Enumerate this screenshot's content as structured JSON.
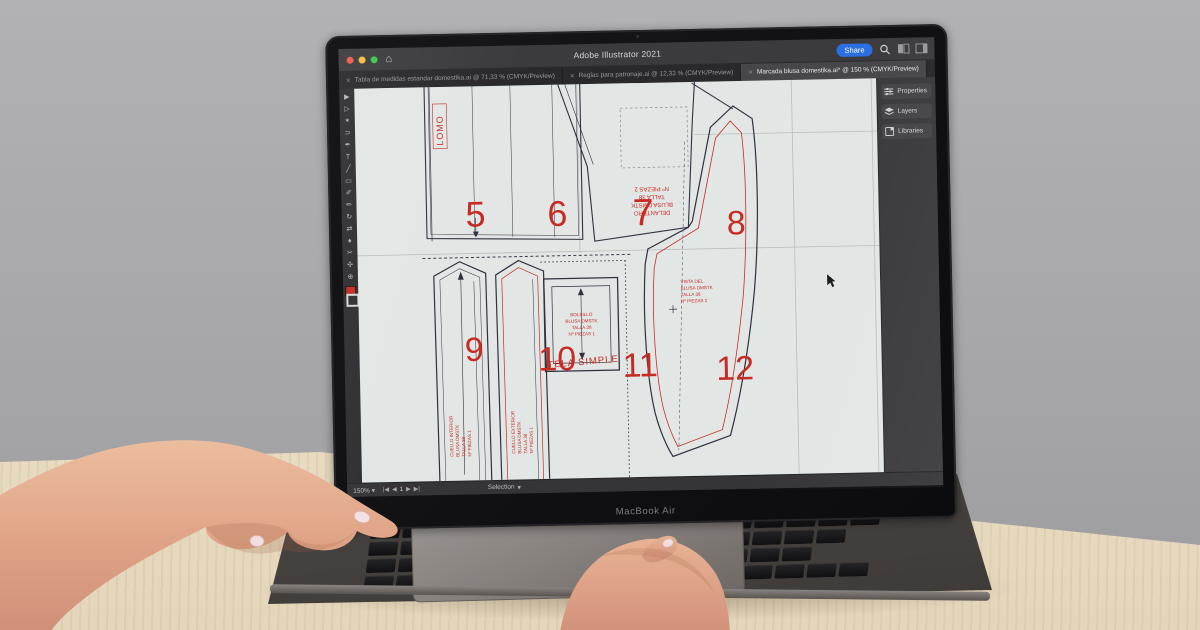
{
  "scene": {
    "macbook_label": "MacBook Air",
    "wall_color": "#a9a9ab",
    "desk_color": "#ece1cb"
  },
  "app": {
    "title": "Adobe Illustrator 2021",
    "share_label": "Share",
    "tabs": [
      {
        "label": "Tabla de medidas estandar domestika.ai @ 71,33 % (CMYK/Preview)",
        "active": false
      },
      {
        "label": "Reglas para patronaje.ai @ 12,33 % (CMYK/Preview)",
        "active": false
      },
      {
        "label": "Marcada blusa domestika.ai* @ 150 % (CMYK/Preview)",
        "active": true
      }
    ],
    "panel_buttons": [
      {
        "label": "Properties"
      },
      {
        "label": "Layers"
      },
      {
        "label": "Libraries"
      }
    ],
    "toolbar": {
      "tools": [
        {
          "name": "selection-tool",
          "glyph": "▶"
        },
        {
          "name": "direct-selection-tool",
          "glyph": "▷"
        },
        {
          "name": "magic-wand-tool",
          "glyph": "✶"
        },
        {
          "name": "lasso-tool",
          "glyph": "⊃"
        },
        {
          "name": "pen-tool",
          "glyph": "✒"
        },
        {
          "name": "type-tool",
          "glyph": "T"
        },
        {
          "name": "line-tool",
          "glyph": "╱"
        },
        {
          "name": "rectangle-tool",
          "glyph": "▭"
        },
        {
          "name": "paintbrush-tool",
          "glyph": "✐"
        },
        {
          "name": "pencil-tool",
          "glyph": "✏"
        },
        {
          "name": "rotate-tool",
          "glyph": "↻"
        },
        {
          "name": "scale-tool",
          "glyph": "⇄"
        },
        {
          "name": "eyedropper-tool",
          "glyph": "♦"
        },
        {
          "name": "scissors-tool",
          "glyph": "✂"
        },
        {
          "name": "hand-tool",
          "glyph": "✣"
        },
        {
          "name": "zoom-tool",
          "glyph": "⊕"
        }
      ]
    },
    "statusbar": {
      "zoom": "150%",
      "artboard": "1",
      "tool_hint": "Selection"
    },
    "icons": {
      "home": "⌂",
      "tab_close": "×",
      "caret": "▾",
      "nav_first": "|◀",
      "nav_prev": "◀",
      "nav_next": "▶",
      "nav_last": "▶|"
    }
  },
  "canvas": {
    "colors": {
      "red": "#c62b24",
      "outline": "#30303f",
      "artboard": "#e2e7e5"
    },
    "piece_numbers": [
      "5",
      "6",
      "7",
      "8",
      "9",
      "10",
      "11",
      "12"
    ],
    "lomo": "LOMO",
    "tela_simple": "TELA SIMPLE",
    "piece7_label": [
      "DELANTERO",
      "BLUSA DMSTK",
      "TALLA 38",
      "Nº PIEZAS 2"
    ],
    "pocket_label": [
      "BOLSILLO",
      "BLUSA DMSTK",
      "TALLA 38",
      "Nº PIEZAS 1"
    ],
    "piece9_label": [
      "CUELLO INTERIOR",
      "BLUSA DMSTK",
      "TALLA 38",
      "Nº PIEZAS 1"
    ],
    "piece10_label": [
      "CUELLO EXTERIOR",
      "BLUSA DMSTK",
      "TALLA 38",
      "Nº PIEZAS 1"
    ],
    "piece12_label": [
      "VISTA DEL.",
      "BLUSA DMSTK",
      "TALLA 38",
      "Nº PIEZAS 2"
    ]
  }
}
